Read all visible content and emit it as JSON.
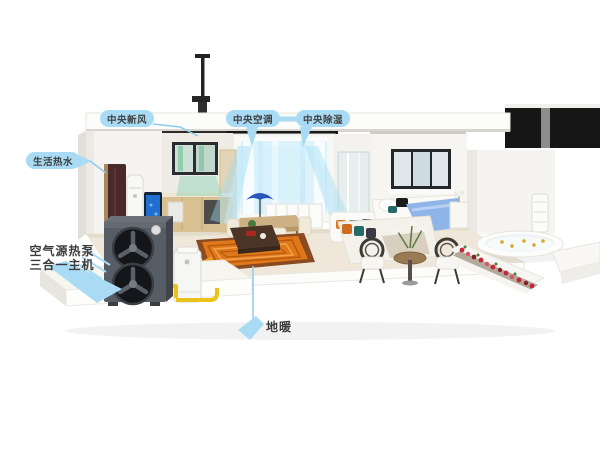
{
  "scene": {
    "description": "3D cutaway house showing an air-source heat pump whole-home system",
    "background": "#ffffff"
  },
  "callouts": {
    "fresh_air": "中央新风",
    "central_ac": "中央空调",
    "dehumidify": "中央除湿",
    "hot_water": "生活热水",
    "heat_pump_line1": "空气源热泵",
    "heat_pump_line2": "三合一主机",
    "floor_heating": "地暖"
  },
  "colors": {
    "callout_blue": "#a9dcf4",
    "dark_text": "#3c3c3c",
    "pipe_yellow": "#e9c31c",
    "coil_orange": "#e0781a",
    "heat_pump_gray": "#575d64",
    "airflow_cyan": "#9fdcf4",
    "airflow_green": "#6ec8a0",
    "duvet_blue": "#8fb4e8",
    "flower_red": "#c42737",
    "aquarium_blue": "#1e6fd0"
  }
}
